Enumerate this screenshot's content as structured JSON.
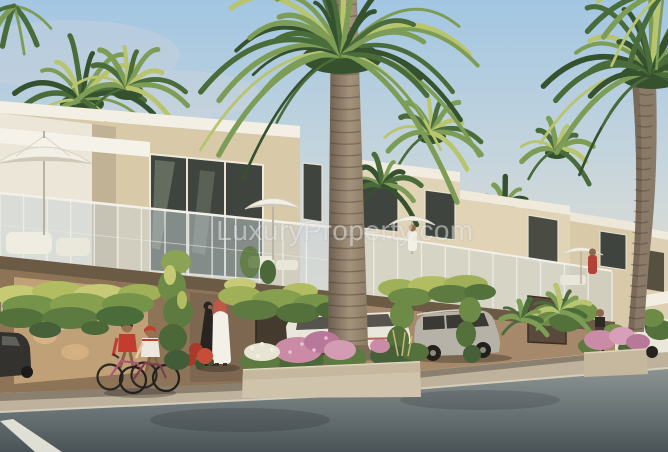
{
  "image": {
    "type": "architectural_render",
    "subject": "Row of modern two-storey townhouses with palm trees, vine-covered carports, balcony umbrellas, residents and parked cars along a street",
    "watermark_text": "LuxuryProperty.com"
  },
  "scene": {
    "umbrella_count": 4,
    "people": [
      "child-on-bicycle-red-shirt",
      "child-on-bicycle-white-shirt",
      "man-in-white-kandura",
      "woman-in-black-abaya",
      "woman-by-planter",
      "person-on-balcony-white",
      "person-on-balcony-red"
    ],
    "vehicles": [
      "dark-car-left",
      "white-car-center",
      "silver-suv",
      "white-car-right"
    ]
  },
  "palette": {
    "sky_top": "#a2c6e2",
    "sky_mid": "#c8d6dc",
    "sky_warm": "#e7decf",
    "sky_horizon": "#f0e7d7",
    "wall_white": "#f3efe4",
    "wall_stucco": "#d8c9a9",
    "wall_stucco_light": "#e0d3b6",
    "wall_shade": "#c2b295",
    "interior_wall": "#c0a077",
    "interior_dark": "#7e6750",
    "glass_dark": "#3f443e",
    "fascia": "#6b5a44",
    "foliage_light": "#b8c46e",
    "foliage_mid": "#7d9c55",
    "foliage_dark": "#4a6b3a",
    "foliage_deep": "#35512e",
    "vine_highlight": "#c6ca74",
    "trunk_light": "#a3927c",
    "trunk_dark": "#6d5e4e",
    "pavement": "#beb29d",
    "road_light": "#8b9392",
    "road_dark": "#4a5458",
    "lane_mark": "#eceade",
    "flower_pink": "#c98ba6",
    "flower_white": "#e8e4d4",
    "accent_red": "#b5453c",
    "kandura_white": "#f3f0e7",
    "abaya_black": "#29241f",
    "car_silver": "#b7b2a8",
    "car_white": "#e9e6dc",
    "umbrella_white": "#f2efe5"
  }
}
